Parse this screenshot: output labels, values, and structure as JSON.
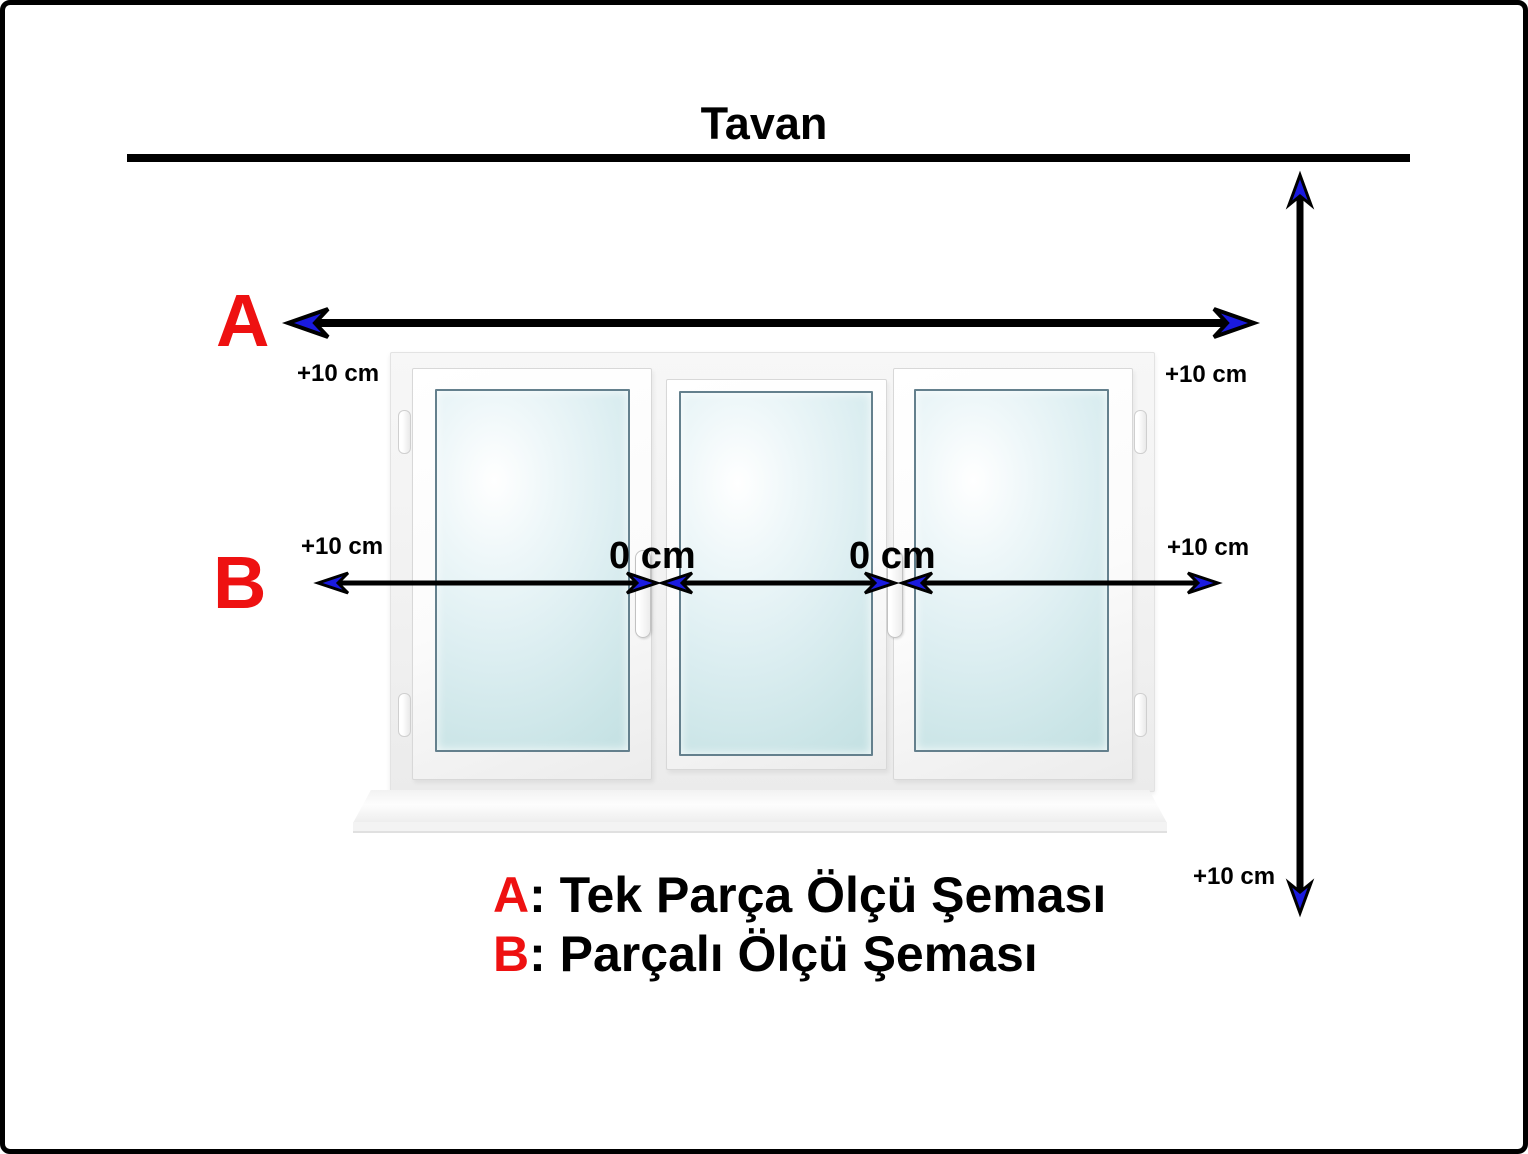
{
  "title": "Tavan",
  "markers": {
    "a": "A",
    "b": "B"
  },
  "measurements": {
    "offset_label": "+10 cm",
    "gap_label": "0 cm"
  },
  "legend": {
    "items": [
      {
        "key": "A",
        "text": ": Tek Parça Ölçü Şeması"
      },
      {
        "key": "B",
        "text": ": Parçalı Ölçü Şeması"
      }
    ]
  },
  "window": {
    "pane_count": 3
  },
  "colors": {
    "marker_red": "#ee1111",
    "arrow_blue": "#1a1adf",
    "line_black": "#000000",
    "glass_blue": "#cbe5e7"
  }
}
